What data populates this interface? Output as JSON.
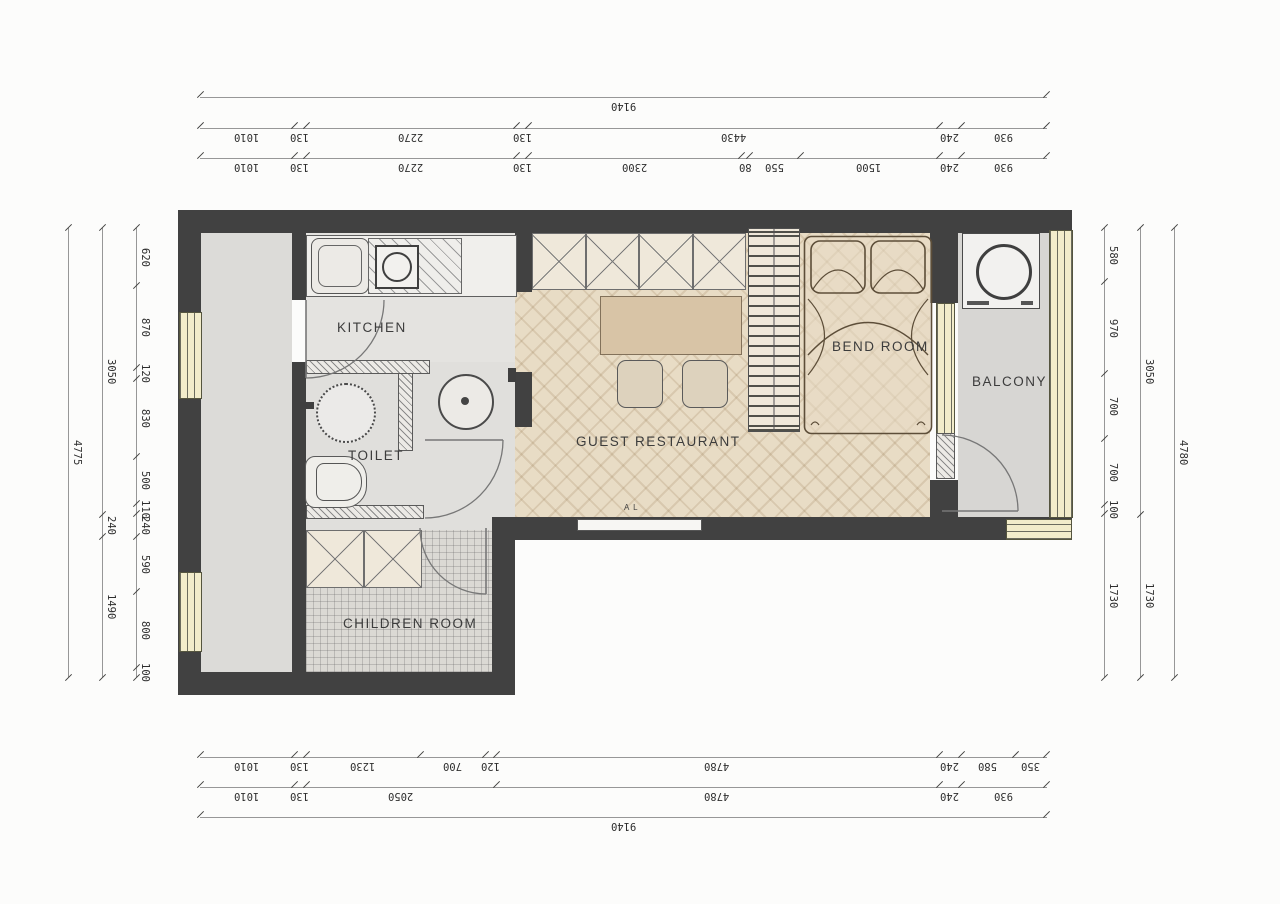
{
  "rooms": {
    "kitchen": "KITCHEN",
    "toilet": "TOILET",
    "guest_restaurant": "GUEST RESTAURANT",
    "bend_room": "BEND ROOM",
    "balcony": "BALCONY",
    "children_room": "CHILDREN ROOM"
  },
  "window_tag": "A L",
  "dimensions": {
    "top1": [
      "9140"
    ],
    "top2": [
      "1010",
      "130",
      "2270",
      "130",
      "4430",
      "240",
      "930"
    ],
    "top3": [
      "1010",
      "130",
      "2270",
      "130",
      "2300",
      "80",
      "550",
      "1500",
      "240",
      "930"
    ],
    "bottom1": [
      "1010",
      "130",
      "1230",
      "700",
      "120",
      "4780",
      "240",
      "580",
      "350"
    ],
    "bottom2": [
      "1010",
      "130",
      "2050",
      "4780",
      "240",
      "930"
    ],
    "bottom3": [
      "9140"
    ],
    "left_outer": [
      "4775"
    ],
    "left_mid": [
      "3050",
      "240",
      "1490"
    ],
    "left_inner": [
      "620",
      "870",
      "120",
      "830",
      "500",
      "110",
      "240",
      "590",
      "800",
      "100"
    ],
    "right_inner": [
      "580",
      "970",
      "700",
      "700",
      "100",
      "1730"
    ],
    "right_mid": [
      "3050",
      "1730"
    ],
    "right_outer": [
      "4780"
    ]
  },
  "colors": {
    "wall": "#414141",
    "window": "#f2ecca",
    "wood_floor": "#e8dcc5",
    "gray_floor": "#dedddb",
    "dim_line": "#979797"
  }
}
